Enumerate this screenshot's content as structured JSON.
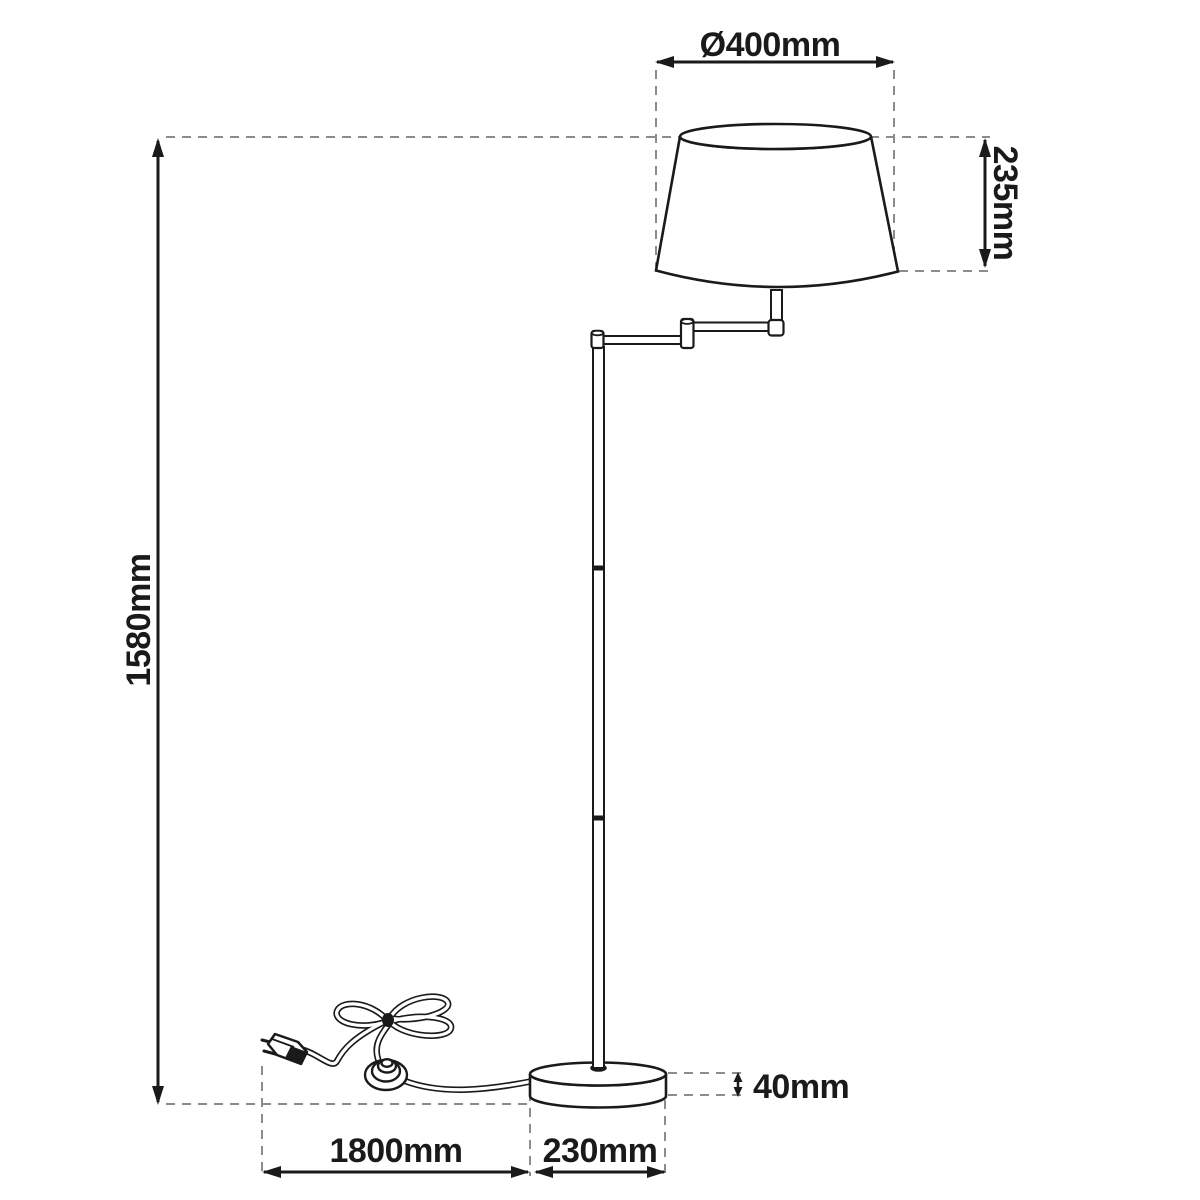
{
  "diagram": {
    "type": "product-dimension-drawing",
    "subject": "swing-arm floor lamp with shade, pole, round base, foot switch and plug",
    "labels": {
      "shade_diameter": "Ø400mm",
      "shade_height": "235mm",
      "total_height": "1580mm",
      "cable_length": "1800mm",
      "base_diameter": "230mm",
      "base_height": "40mm"
    },
    "colors": {
      "outline": "#1a1a1a",
      "dash": "#8c8c8c",
      "background": "#ffffff"
    }
  }
}
